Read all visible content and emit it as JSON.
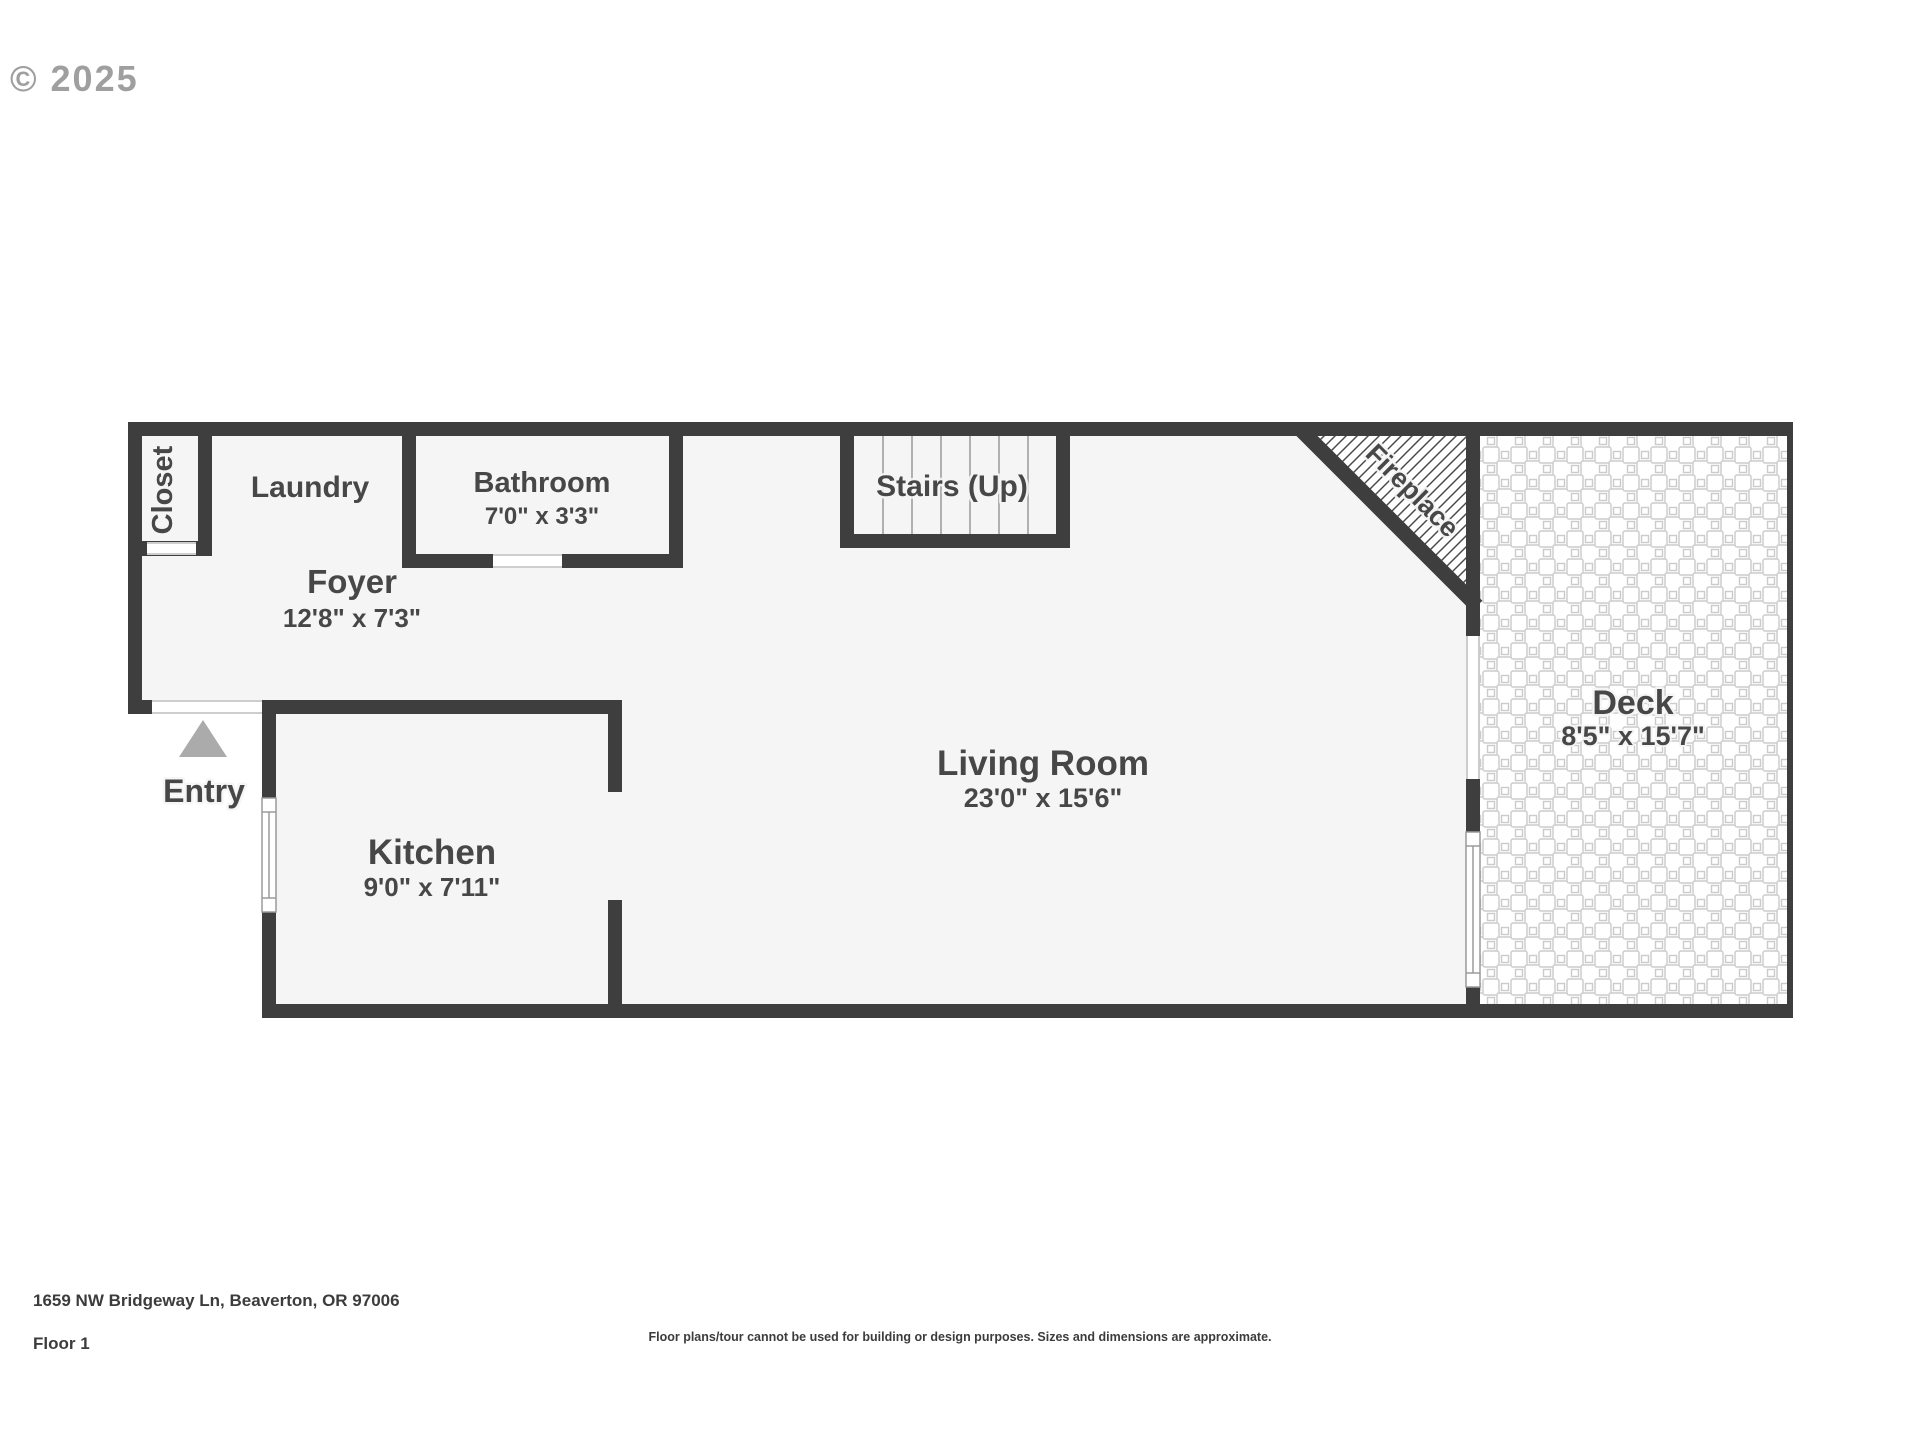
{
  "watermark": {
    "text": "© 2025"
  },
  "floor_plan": {
    "colors": {
      "wall": "#3e3e3e",
      "floor": "#f5f5f5",
      "outside": "#ffffff",
      "label_text": "#474747",
      "entry_arrow": "#ababab",
      "deck_tile_line": "#cbcbcb"
    },
    "rooms": {
      "closet": {
        "label": "Closet"
      },
      "laundry": {
        "label": "Laundry"
      },
      "bathroom": {
        "label": "Bathroom",
        "dims": "7'0\" x 3'3\""
      },
      "foyer": {
        "label": "Foyer",
        "dims": "12'8\" x 7'3\""
      },
      "stairs": {
        "label": "Stairs (Up)"
      },
      "fireplace": {
        "label": "Fireplace"
      },
      "living_room": {
        "label": "Living Room",
        "dims": "23'0\" x 15'6\""
      },
      "kitchen": {
        "label": "Kitchen",
        "dims": "9'0\" x 7'11\""
      },
      "deck": {
        "label": "Deck",
        "dims": "8'5\" x 15'7\""
      },
      "entry": {
        "label": "Entry"
      }
    }
  },
  "footer": {
    "address": "1659 NW Bridgeway Ln, Beaverton, OR 97006",
    "floor_label": "Floor 1",
    "disclaimer": "Floor plans/tour cannot be used for building or design purposes. Sizes and dimensions are approximate."
  }
}
